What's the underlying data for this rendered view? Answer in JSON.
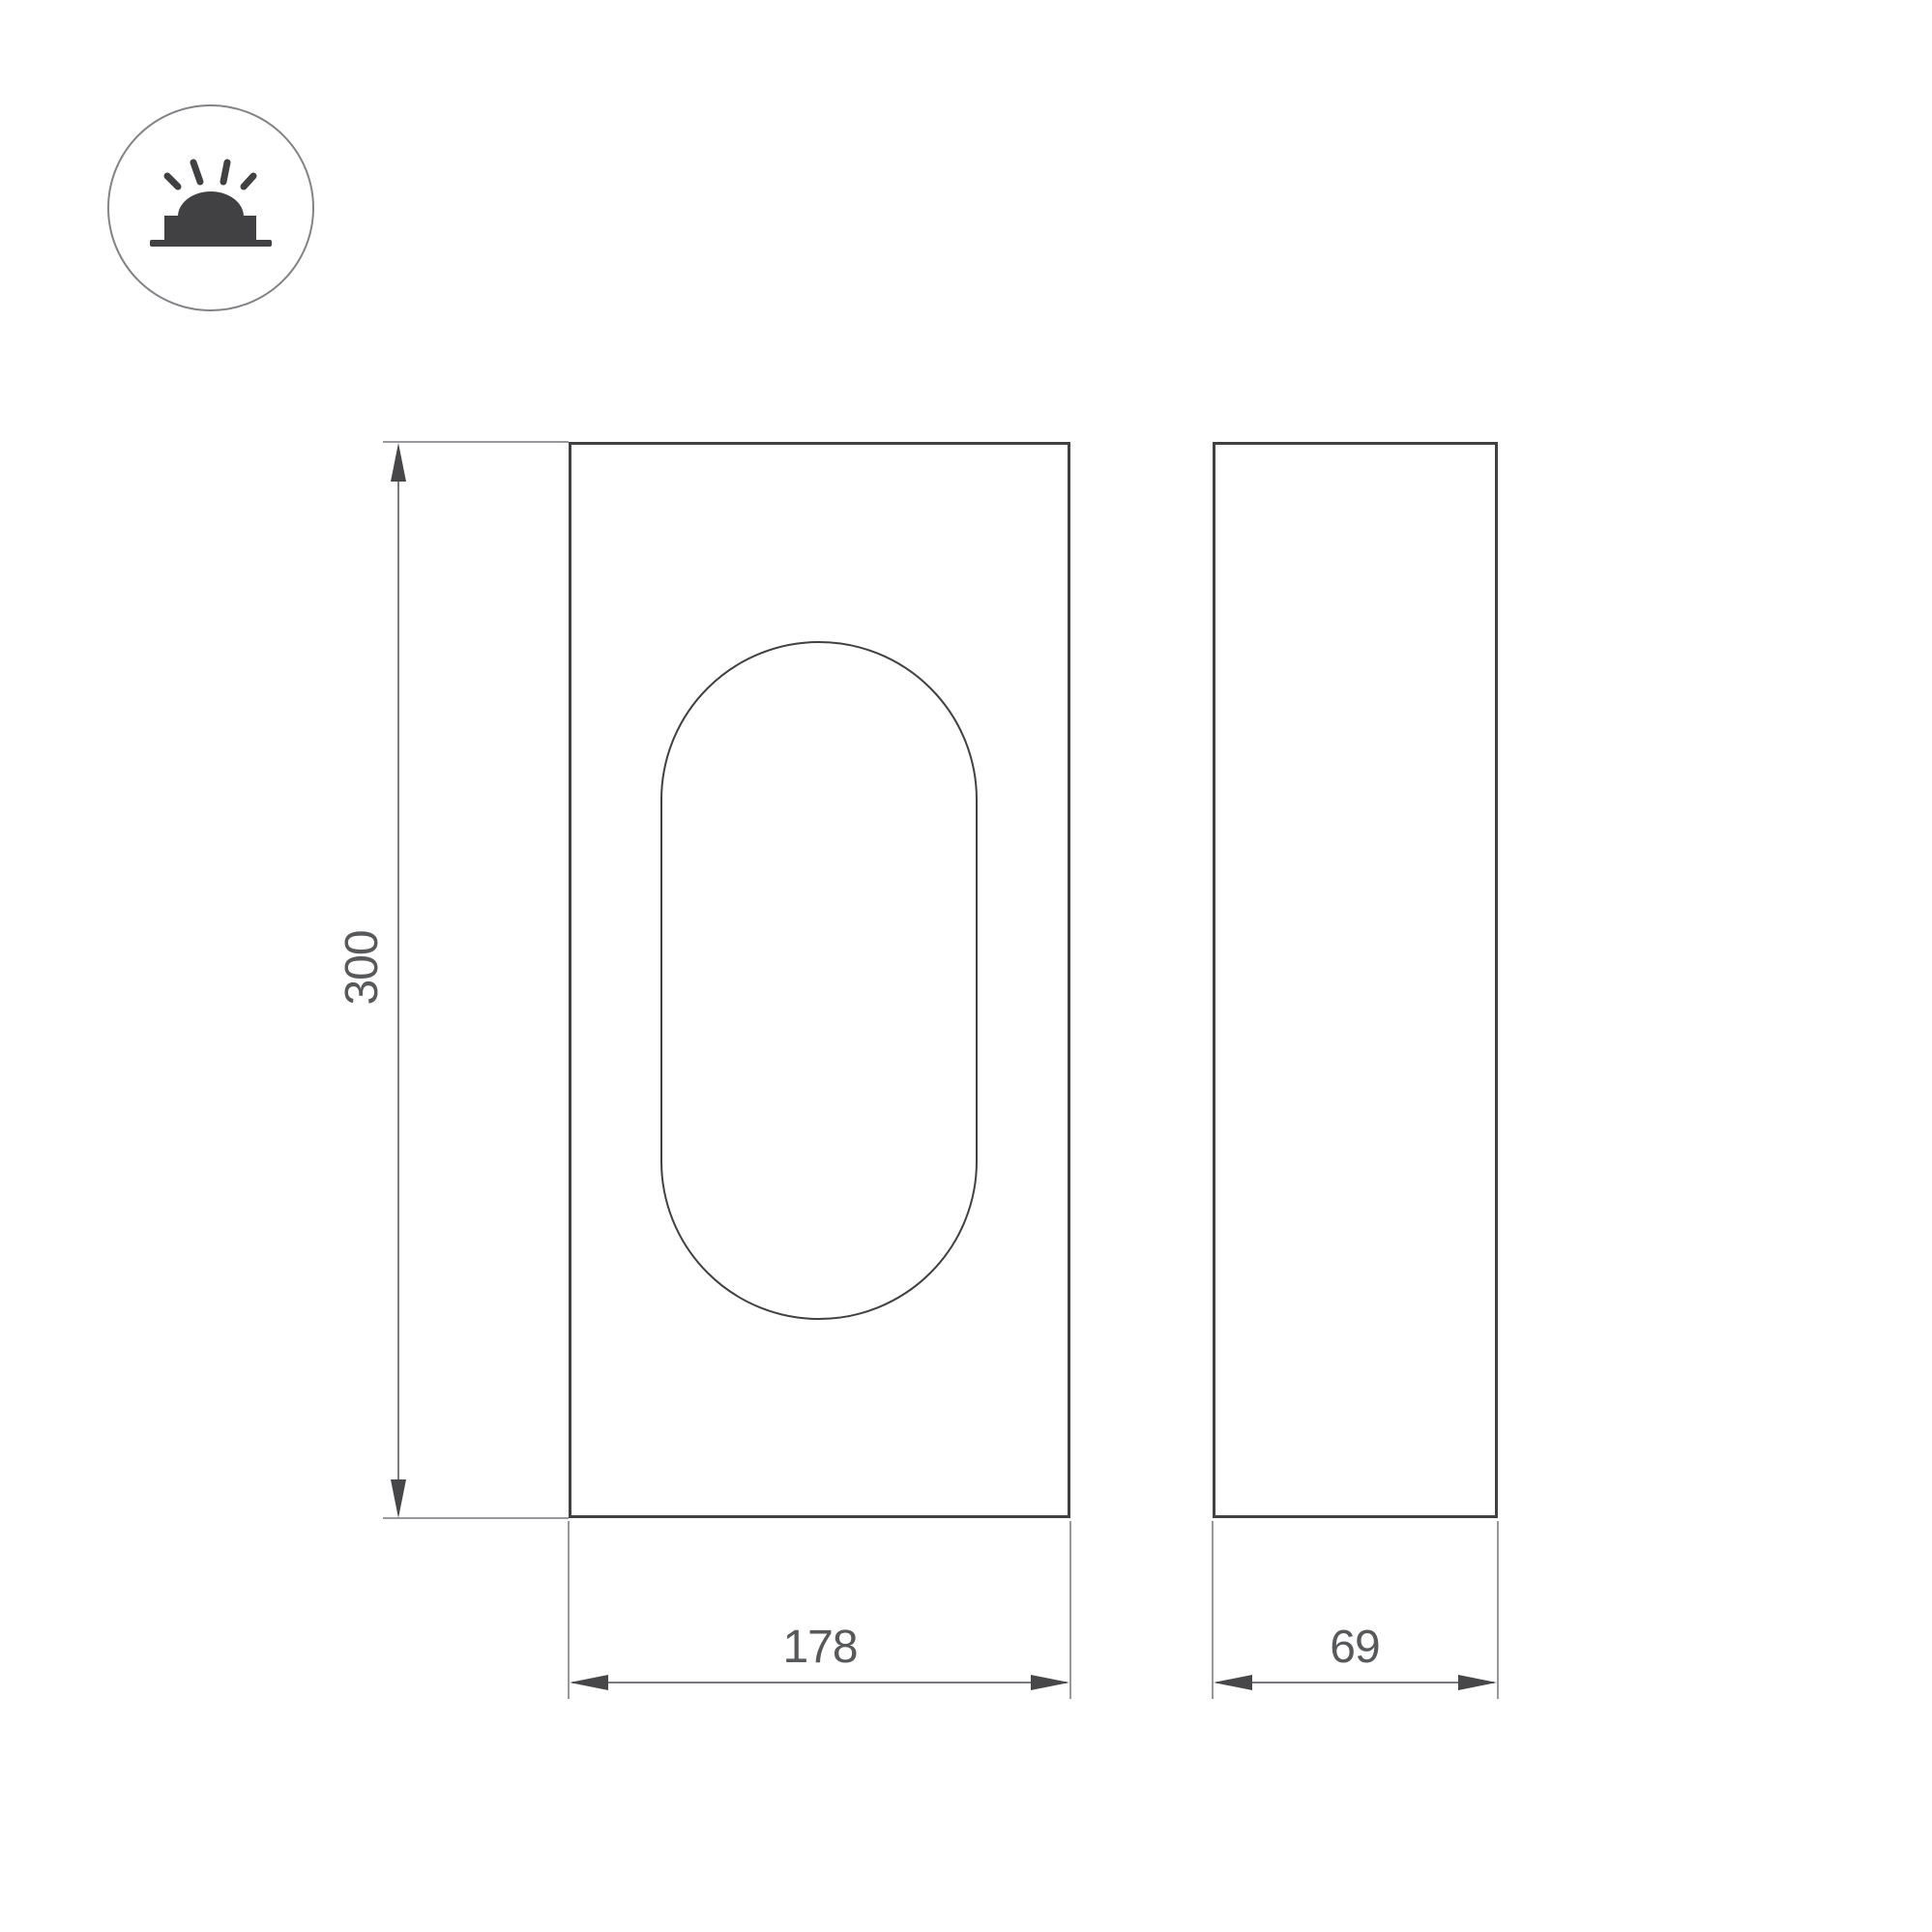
{
  "diagram": {
    "title": "luminaire-dimension-drawing",
    "views": {
      "front": {
        "name": "front view with stadium-shaped diffuser"
      },
      "side": {
        "name": "side profile view"
      }
    },
    "dimensions": {
      "height": {
        "value": "300"
      },
      "width": {
        "value": "178"
      },
      "depth": {
        "value": "69"
      }
    },
    "icon": {
      "name": "surface-mounted-light-icon"
    },
    "colors": {
      "background": "#ffffff",
      "outline": "#414042",
      "dimension_line": "#7a7b7e",
      "arrow": "#47474a",
      "dimension_text": "#58595b",
      "extension": "#97999c",
      "icon_glyph": "#414042",
      "icon_circle": "#818386"
    }
  }
}
